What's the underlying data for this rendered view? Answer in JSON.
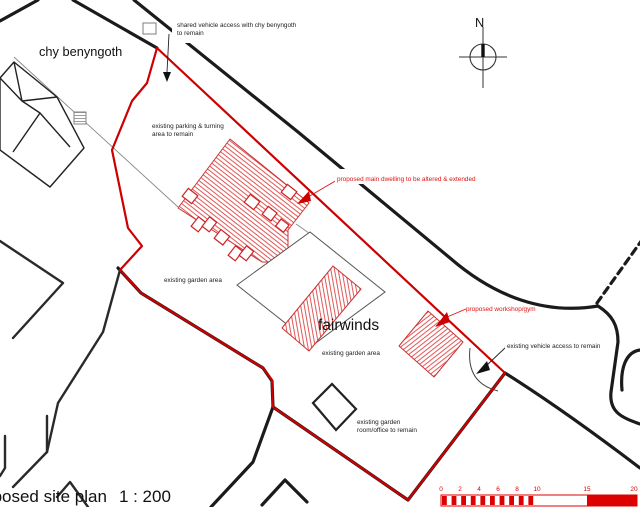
{
  "plan": {
    "title": "proposed site plan",
    "scale_text": "1 : 200",
    "north_label": "N"
  },
  "labels": {
    "neighbor_house": "chy benyngoth",
    "site_name": "fairwinds",
    "shared_access_line1": "shared vehicle access with chy benyngoth",
    "shared_access_line2": "to remain",
    "parking_line1": "existing parking & turning",
    "parking_line2": "area to remain",
    "main_dwelling": "proposed main dwelling to be altered & extended",
    "garden_area_upper": "existing garden area",
    "garden_area_lower": "existing garden area",
    "workshop": "proposed workshop/gym",
    "vehicle_access": "existing vehicle access to remain",
    "garden_room_line1": "existing garden",
    "garden_room_line2": "room/office to remain"
  },
  "scalebar": {
    "ticks": [
      "0",
      "2",
      "4",
      "6",
      "8",
      "10",
      "15",
      "20"
    ]
  },
  "colors": {
    "site_boundary_red": "#cc0000",
    "proposed_hatch_red": "#e05555",
    "annotation_red": "#e01010",
    "linework_black": "#1b1b1b",
    "background": "#ffffff"
  }
}
